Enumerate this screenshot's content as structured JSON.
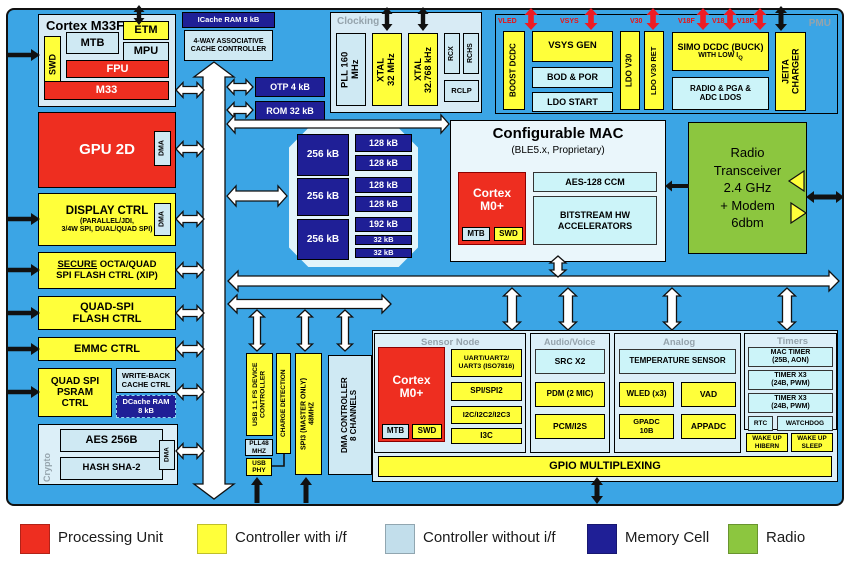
{
  "colors": {
    "panel_blue": "#3BA5E5",
    "yellow": "#FFFF3A",
    "light_blue": "#CFE9F3",
    "cyan": "#CCF4F9",
    "red": "#EE2E20",
    "navy": "#1F1F96",
    "green": "#8CC63F"
  },
  "cortex": {
    "title": "Cortex M33F",
    "swd": "SWD",
    "mtb": "MTB",
    "etm": "ETM",
    "mpu": "MPU",
    "fpu": "FPU",
    "core": "M33"
  },
  "icache": {
    "ram": "ICache RAM 8 kB",
    "ctrl": "4-WAY ASSOCIATIVE\nCACHE CONTROLLER"
  },
  "rom_otp": {
    "otp": "OTP 4 kB",
    "rom": "ROM 32 kB"
  },
  "clocking": {
    "label": "Clocking",
    "pll": "PLL 160\nMHz",
    "xtal1": "XTAL\n32 MHz",
    "xtal2": "XTAL\n32.768 kHz",
    "rcx": "RCX",
    "rchs": "RCHS",
    "rclp": "RCLP"
  },
  "pmu": {
    "label": "PMU",
    "rails": [
      "VLED",
      "VSYS",
      "V30",
      "V18F",
      "V18",
      "V18P"
    ],
    "boost": "BOOST DCDC",
    "vsys_gen": "VSYS GEN",
    "bod": "BOD & POR",
    "ldo_start": "LDO START",
    "ldo_v30": "LDO V30",
    "ldo_v30_ret": "LDO V30 RET",
    "simo": "SIMO DCDC (BUCK)",
    "simo_sub": "WITH LOW I",
    "simo_sub_q": "Q",
    "radio_ldos": "RADIO & PGA &\nADC LDOS",
    "jeita": "JEITA\nCHARGER"
  },
  "left": {
    "gpu": "GPU 2D",
    "dma": "DMA",
    "display_title": "DISPLAY CTRL",
    "display_sub": "(PARALLEL/JDI,\n3/4W SPI, DUAL/QUAD SPI)",
    "secure_u": "SECURE",
    "secure_r": " OCTA/QUAD",
    "secure_l2": "SPI FLASH CTRL (XIP)",
    "quad": "QUAD-SPI\nFLASH CTRL",
    "emmc": "EMMC CTRL",
    "psram": "QUAD SPI\nPSRAM\nCTRL",
    "writeback": "WRITE-BACK\nCACHE CTRL",
    "dcache": "DCache RAM\n8 kB"
  },
  "crypto": {
    "label": "Crypto",
    "aes": "AES 256B",
    "hash": "HASH SHA-2",
    "dma": "DMA"
  },
  "memory": {
    "left": [
      "256 kB",
      "256 kB",
      "256 kB"
    ],
    "right": [
      "128 kB",
      "128 kB",
      "128 kB",
      "128 kB",
      "192 kB",
      "32 kB",
      "32 kB"
    ]
  },
  "buses": {
    "ahb": "MULTILAYER AMBA AHB BUS",
    "slow": "AMBA APB (SLOW)",
    "fast": "AMBA APB (FAST)"
  },
  "mac": {
    "title": "Configurable MAC",
    "subtitle": "(BLE5.x, Proprietary)",
    "cortex": "Cortex\nM0+",
    "mtb": "MTB",
    "swd": "SWD",
    "aes": "AES-128 CCM",
    "bitstream": "BITSTREAM HW\nACCELERATORS"
  },
  "radio": {
    "text": "Radio\nTransceiver\n2.4 GHz\n+ Modem\n6dbm"
  },
  "usb": {
    "ctrl": "USB 1.1 FS DEVICE\nCONTROLLER",
    "pll48": "PLL48\nMHZ",
    "phy": "USB\nPHY",
    "charge": "CHARGE DETECTION",
    "spi3": "SPI3 (MASTER ONLY)\n48MHZ",
    "dma": "DMA CONTROLLER\n8 CHANNELS"
  },
  "sensor": {
    "label": "Sensor Node",
    "cortex": "Cortex\nM0+",
    "mtb": "MTB",
    "swd": "SWD",
    "uart": "UART/UART2/\nUART3 (ISO7816)",
    "spi": "SPI/SPI2",
    "i2c": "I2C/I2C2/I2C3",
    "i3c": "I3C"
  },
  "audio": {
    "label": "Audio/Voice",
    "src": "SRC X2",
    "pdm": "PDM (2 MIC)",
    "pcm": "PCM/I2S"
  },
  "analog": {
    "label": "Analog",
    "temp": "TEMPERATURE SENSOR",
    "wled": "WLED (x3)",
    "vad": "VAD",
    "gpadc": "GPADC\n10B",
    "appadc": "APPADC"
  },
  "timers": {
    "label": "Timers",
    "t1": "MAC TIMER\n(25B, AON)",
    "t2": "TIMER X3\n(24B, PWM)",
    "t3": "TIMER X3\n(24B, PWM)",
    "rtc": "RTC",
    "wdog": "WATCHDOG"
  },
  "wakeup": {
    "hibern": "WAKE UP\nHIBERN",
    "sleep": "WAKE UP\nSLEEP"
  },
  "gpio": "GPIO MULTIPLEXING",
  "legend": {
    "items": [
      {
        "label": "Processing Unit",
        "color": "#EE2E20"
      },
      {
        "label": "Controller with i/f",
        "color": "#FFFF3A"
      },
      {
        "label": "Controller without i/f",
        "color": "#C2DEEB"
      },
      {
        "label": "Memory Cell",
        "color": "#1F1F96"
      },
      {
        "label": "Radio",
        "color": "#8CC63F"
      }
    ]
  }
}
